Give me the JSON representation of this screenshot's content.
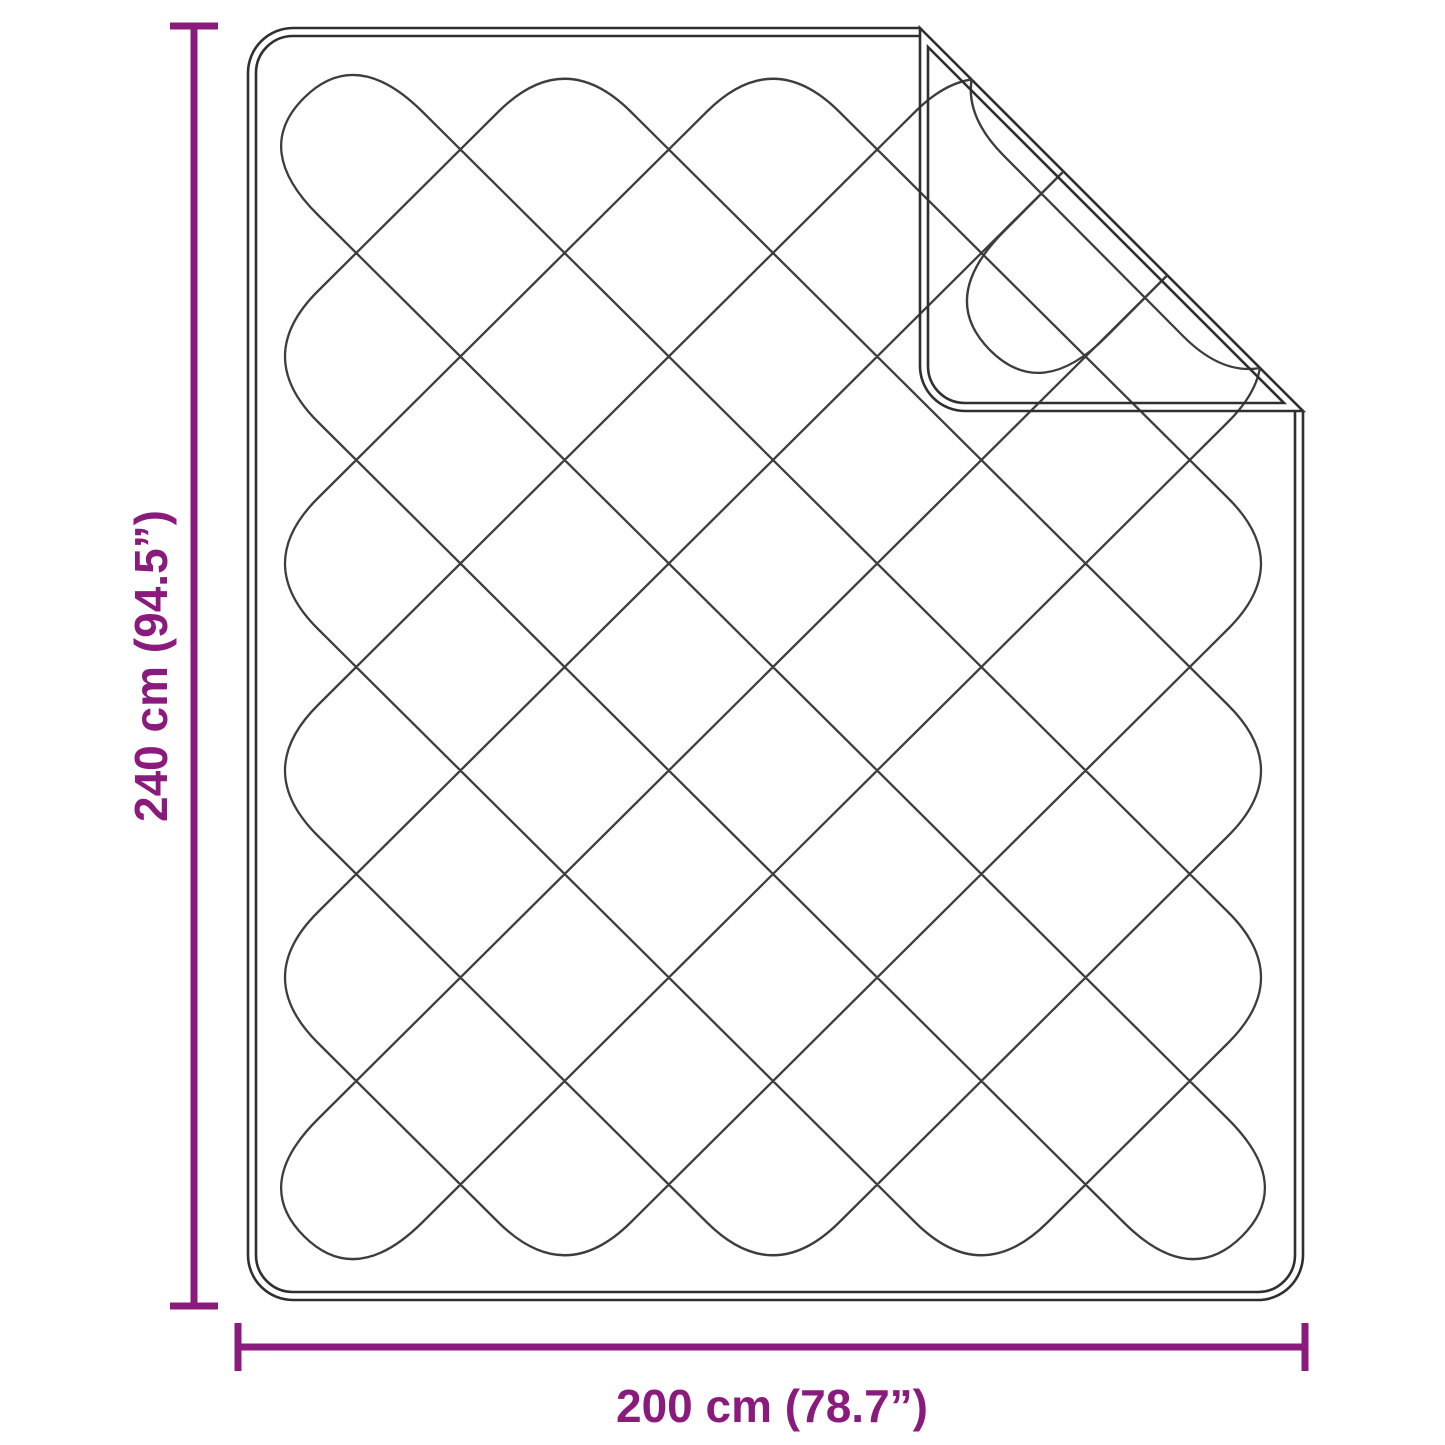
{
  "diagram": {
    "type": "product-dimension-diagram",
    "subject": "quilted blanket with folded corner"
  },
  "colors": {
    "accent": "#8B1A7D",
    "outline": "#2f2f2f",
    "quilt": "#3d3d3d",
    "bg": "#ffffff"
  },
  "dimensions": {
    "height": {
      "label": "240 cm (94.5”)",
      "cm": "240",
      "inches": "94.5"
    },
    "width": {
      "label": "200 cm (78.7”)",
      "cm": "200",
      "inches": "78.7"
    }
  }
}
